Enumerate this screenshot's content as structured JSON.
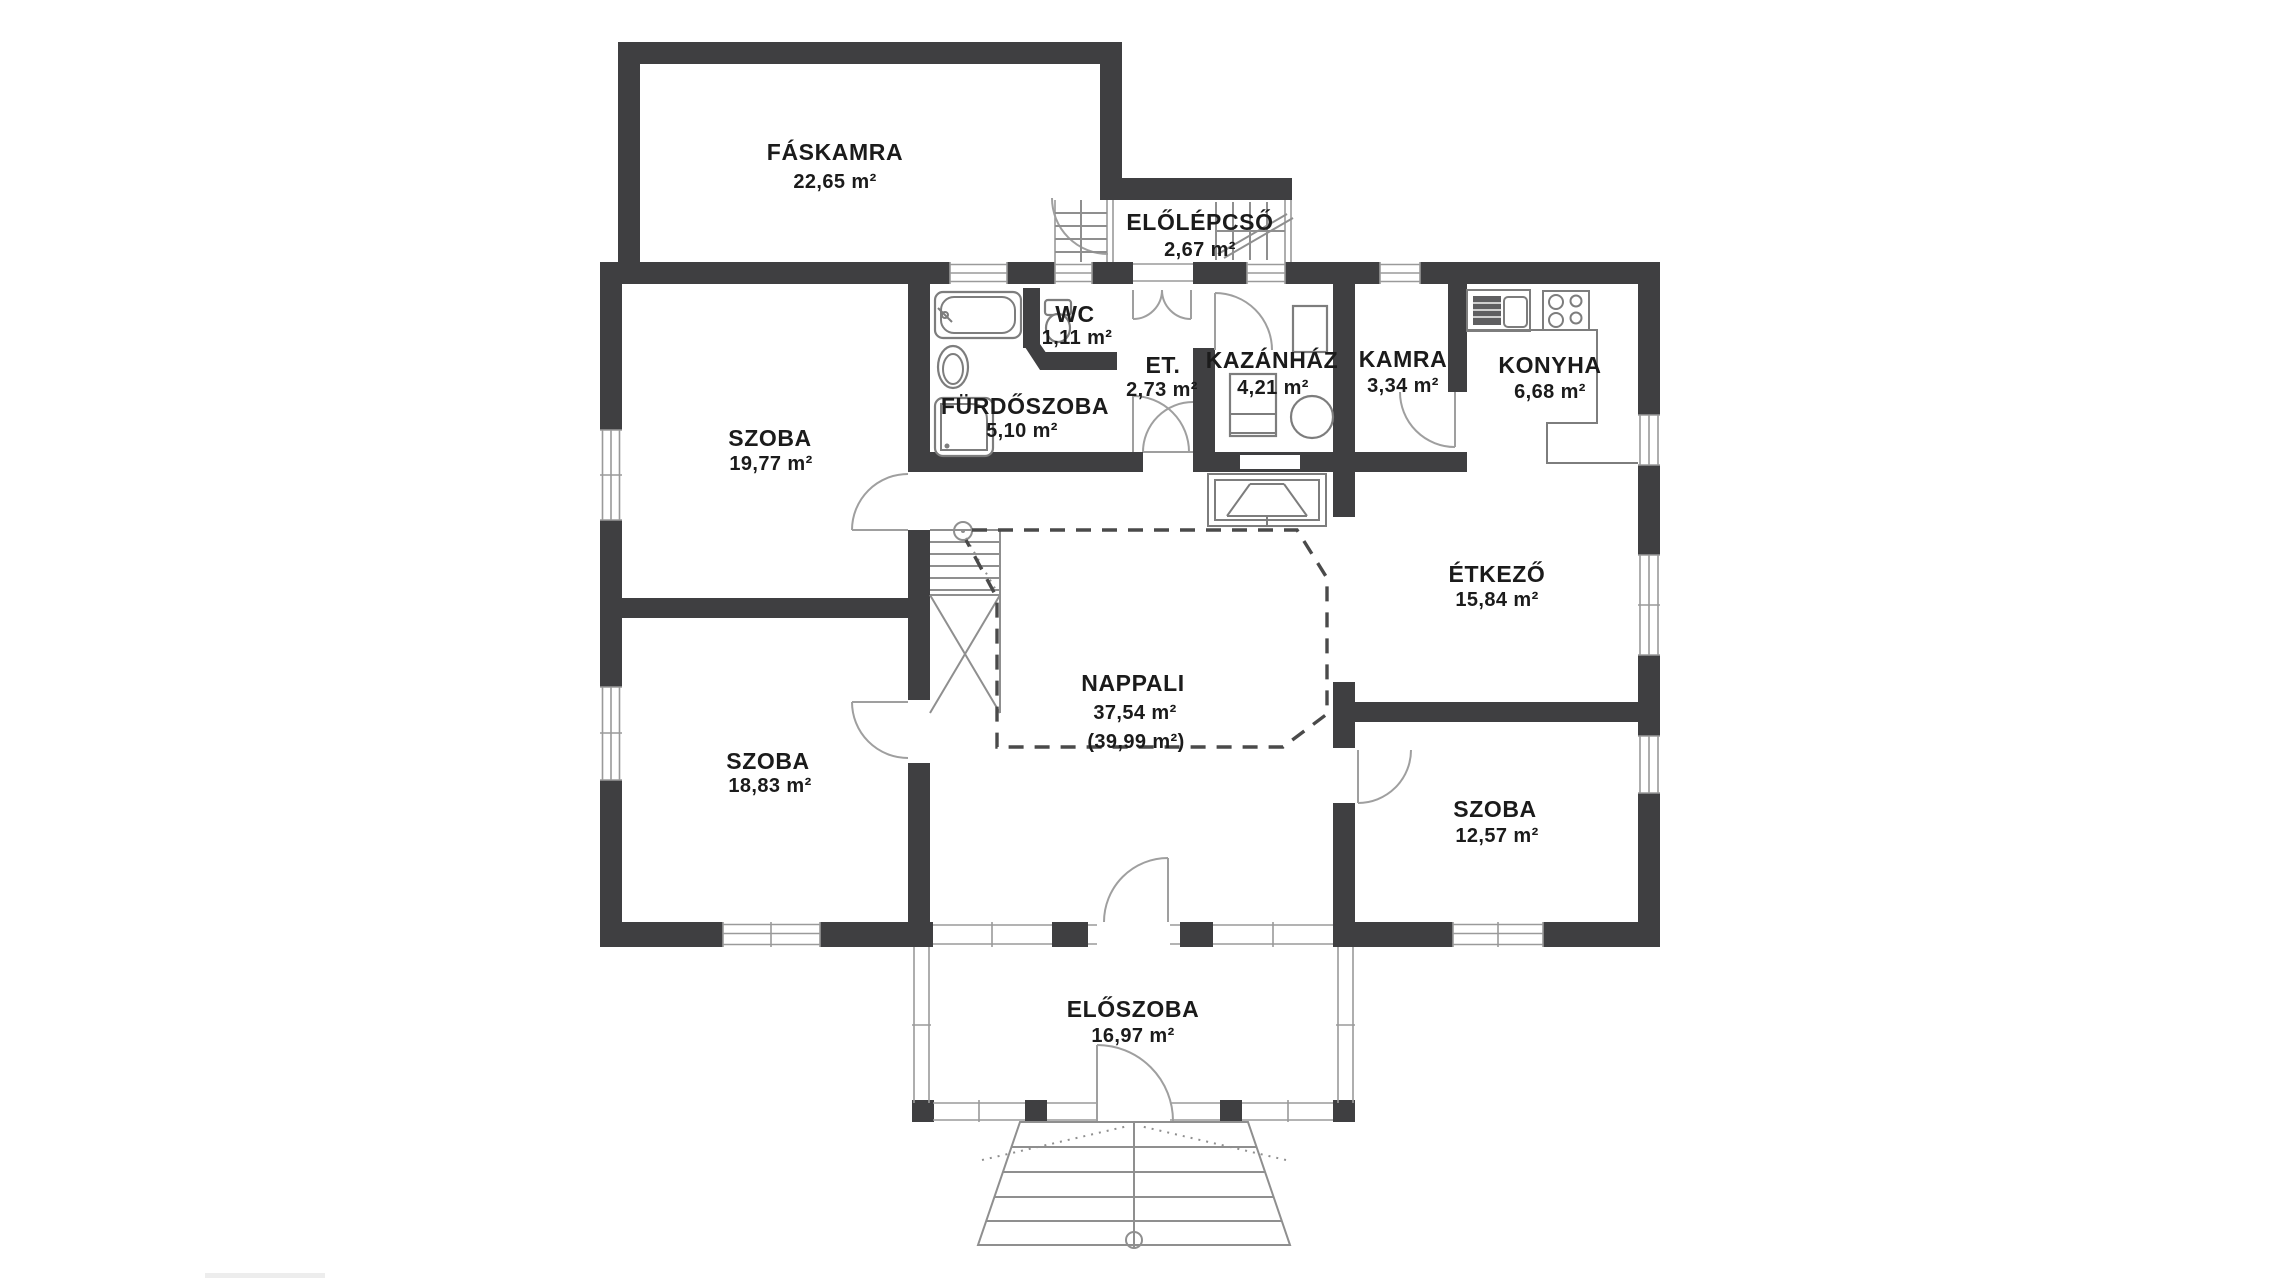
{
  "title": "floor-plan",
  "rooms": {
    "faskamra": {
      "name": "FÁSKAMRA",
      "area": "22,65 m²"
    },
    "elolepcso": {
      "name": "ELŐLÉPCSŐ",
      "area": "2,67 m²"
    },
    "wc": {
      "name": "WC",
      "area": "1,11 m²"
    },
    "furdoszoba": {
      "name": "FÜRDŐSZOBA",
      "area": "5,10 m²"
    },
    "et": {
      "name": "ET.",
      "area": "2,73 m²"
    },
    "kazanhaz": {
      "name": "KAZÁNHÁZ",
      "area": "4,21 m²"
    },
    "kamra": {
      "name": "KAMRA",
      "area": "3,34 m²"
    },
    "konyha": {
      "name": "KONYHA",
      "area": "6,68 m²"
    },
    "szoba_nw": {
      "name": "SZOBA",
      "area": "19,77 m²"
    },
    "etkezo": {
      "name": "ÉTKEZŐ",
      "area": "15,84 m²"
    },
    "nappali": {
      "name": "NAPPALI",
      "area": "37,54 m²",
      "area_alt": "(39,99 m²)"
    },
    "szoba_sw": {
      "name": "SZOBA",
      "area": "18,83 m²"
    },
    "szoba_se": {
      "name": "SZOBA",
      "area": "12,57 m²"
    },
    "eloszoba": {
      "name": "ELŐSZOBA",
      "area": "16,97 m²"
    }
  },
  "colors": {
    "wall": "#3f3f41",
    "thin_line": "#8f8f8f",
    "dashed_boundary": "#4a4a4a",
    "text": "#1b1b1b",
    "background": "#ffffff"
  }
}
